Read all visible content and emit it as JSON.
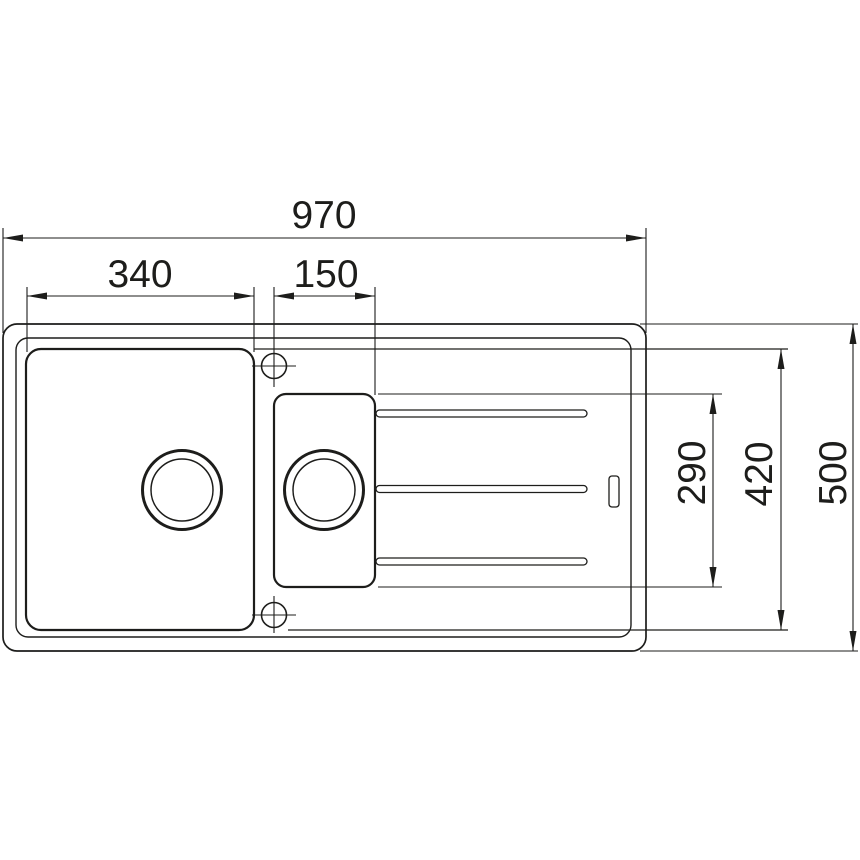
{
  "drawing": {
    "title": "kitchen-sink-dimension-drawing-top-view",
    "units": "mm",
    "line_color": "#1d1d1b",
    "background_color": "#ffffff",
    "dimensions": {
      "total_width": {
        "value": "970"
      },
      "main_bowl_width": {
        "value": "340"
      },
      "half_bowl_width": {
        "value": "150"
      },
      "total_depth": {
        "value": "500"
      },
      "inner_depth": {
        "value": "420"
      },
      "half_bowl_depth": {
        "value": "290"
      }
    },
    "features": {
      "main_bowl": "large bowl with drain",
      "half_bowl": "small half bowl with drain",
      "drainer_grooves_count": 3,
      "tap_holes_count": 2,
      "overflow_slot": "right side of drainer"
    }
  }
}
